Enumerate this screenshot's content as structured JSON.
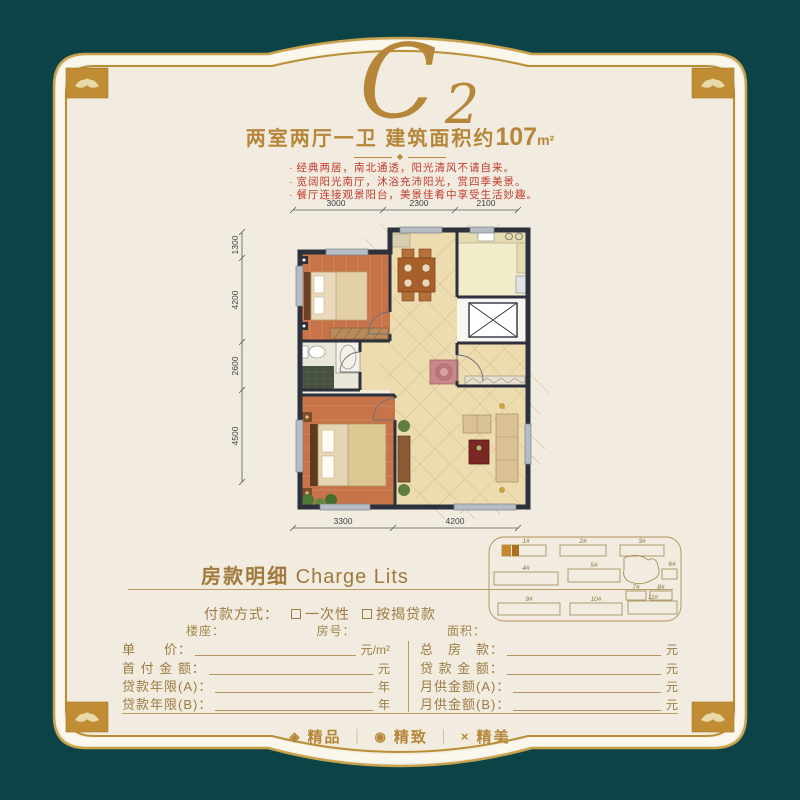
{
  "brand": {
    "letter": "C",
    "number": "2"
  },
  "subtitle": {
    "prefix": "两室两厅一卫 建筑面积约",
    "area": "107",
    "unit": "m²",
    "ornament": "◆"
  },
  "features": {
    "bullet": "·",
    "items": [
      "经典两居，南北通透，阳光清风不请自来。",
      "宽阔阳光南厅，沐浴充沛阳光，赏四季美景。",
      "餐厅连接观景阳台，美景佳肴中享受生活妙趣。"
    ]
  },
  "plan": {
    "dims_top": [
      "3000",
      "2300",
      "2100"
    ],
    "dims_left": [
      "1300",
      "4200",
      "2600",
      "4500"
    ],
    "dims_bottom": [
      "3300",
      "4200"
    ]
  },
  "sitemap": {
    "labels": [
      "1#",
      "2#",
      "3#",
      "4#",
      "5#",
      "6#",
      "7#",
      "8#",
      "9#",
      "10#",
      "11#"
    ]
  },
  "charge": {
    "title_cn": "房款明细",
    "title_en": " Charge Lits",
    "payment_label": "付款方式：",
    "option_once": "一次性",
    "option_mortgage": "按揭贷款",
    "building_label": "楼座：",
    "room_label": "房号：",
    "area_label": "面积：",
    "left_rows": [
      {
        "label": "单　　价：",
        "unit": "元/m²"
      },
      {
        "label": "首 付 金 额：",
        "unit": "元"
      },
      {
        "label": "贷款年限(A)：",
        "unit": "年"
      },
      {
        "label": "贷款年限(B)：",
        "unit": "年"
      }
    ],
    "right_rows": [
      {
        "label": "总　房　款：",
        "unit": "元"
      },
      {
        "label": "贷 款 金 额：",
        "unit": "元"
      },
      {
        "label": "月供金额(A)：",
        "unit": "元"
      },
      {
        "label": "月供金额(B)：",
        "unit": "元"
      }
    ]
  },
  "footer": {
    "separator": "｜",
    "items": [
      {
        "icon": "◈",
        "label": "精品"
      },
      {
        "icon": "◉",
        "label": "精致"
      },
      {
        "icon": "×",
        "label": "精美"
      }
    ]
  },
  "colors": {
    "teal": "#0c4347",
    "gold": "#c9a14d",
    "gold_dark": "#b08428",
    "cream": "#f1ecdf",
    "text_brown": "#9d7b42",
    "red": "#c23b2e"
  }
}
